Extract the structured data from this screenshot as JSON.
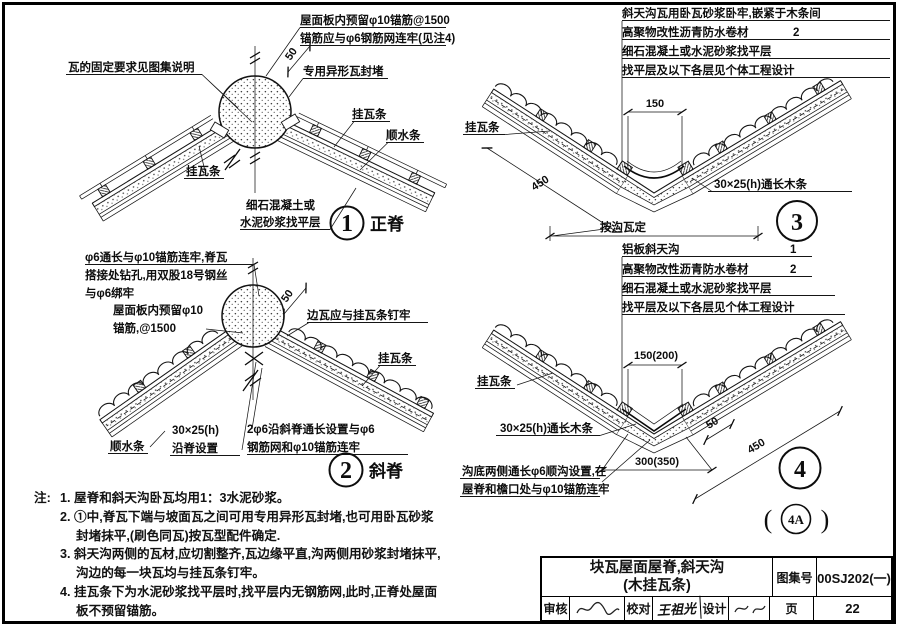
{
  "ui": {
    "colors": {
      "ink": "#111111",
      "paper": "#ffffff"
    }
  },
  "d1": {
    "num": "1",
    "name": "正脊",
    "anchor1": "屋面板内预留φ10锚筋@1500",
    "anchor2": "锚筋应与φ6钢筋网连牢(见注4)",
    "fix": "瓦的固定要求见图集说明",
    "special": "专用异形瓦封堵",
    "batten_r": "挂瓦条",
    "shun": "顺水条",
    "batten_l": "挂瓦条",
    "screed1": "细石混凝土或",
    "screed2": "水泥砂浆找平层",
    "dim50": "50"
  },
  "d2": {
    "num": "2",
    "name": "斜脊",
    "w1": "φ6通长与φ10锚筋连牢,脊瓦",
    "w2": "搭接处钻孔,用双股18号钢丝",
    "w3": "与φ6绑牢",
    "a1": "屋面板内预留φ10",
    "a2": "锚筋,@1500",
    "edge": "边瓦应与挂瓦条钉牢",
    "batten": "挂瓦条",
    "shun": "顺水条",
    "wood1": "30×25(h)",
    "wood2": "沿脊设置",
    "bar1": "2φ6沿斜脊通长设置与φ6",
    "bar2": "钢筋网和φ10锚筋连牢",
    "dim50": "50"
  },
  "d3": {
    "num": "3",
    "c1": "斜天沟瓦用卧瓦砂浆卧牢,嵌紧于木条间",
    "c2": "高聚物改性沥青防水卷材",
    "c2n": "2",
    "c3": "细石混凝土或水泥砂浆找平层",
    "c4": "找平层及以下各层见个体工程设计",
    "batten": "挂瓦条",
    "wood": "30×25(h)通长木条",
    "dim150": "150",
    "dim450": "450",
    "dimgou": "按沟瓦定"
  },
  "d4": {
    "num": "4",
    "alt": "4A",
    "lparen": "(",
    "rparen": ")",
    "c1": "铝板斜天沟",
    "c1n": "1",
    "c2": "高聚物改性沥青防水卷材",
    "c2n": "2",
    "c3": "细石混凝土或水泥砂浆找平层",
    "c4": "找平层及以下各层见个体工程设计",
    "batten": "挂瓦条",
    "wood": "30×25(h)通长木条",
    "rebar1": "沟底两侧通长φ6顺沟设置,在",
    "rebar2": "屋脊和檐口处与φ10锚筋连牢",
    "dim150": "150(200)",
    "dim300": "300(350)",
    "dim50": "50",
    "dim450": "450"
  },
  "notes": {
    "prefix": "注:",
    "n1": "1. 屋脊和斜天沟卧瓦均用1：3水泥砂浆。",
    "n2a": "2. ①中,脊瓦下端与坡面瓦之间可用专用异形瓦封堵,也可用卧瓦砂浆",
    "n2b": "封堵抹平,(刷色同瓦)按瓦型配件确定.",
    "n3a": "3. 斜天沟两侧的瓦材,应切割整齐,瓦边缘平直,沟两侧用砂浆封堵抹平,",
    "n3b": "沟边的每一块瓦均与挂瓦条钉牢。",
    "n4a": "4. 挂瓦条下为水泥砂浆找平层时,找平层内无钢筋网,此时,正脊处屋面",
    "n4b": "板不预留锚筋。"
  },
  "titleblock": {
    "title1": "块瓦屋面屋脊,斜天沟",
    "title2": "(木挂瓦条)",
    "atlas_label": "图集号",
    "atlas_no": "00SJ202(一)",
    "page_label": "页",
    "page_no": "22",
    "audit_label": "审核",
    "proof_label": "校对",
    "design_label": "设计",
    "proof_sig": "王祖光"
  }
}
